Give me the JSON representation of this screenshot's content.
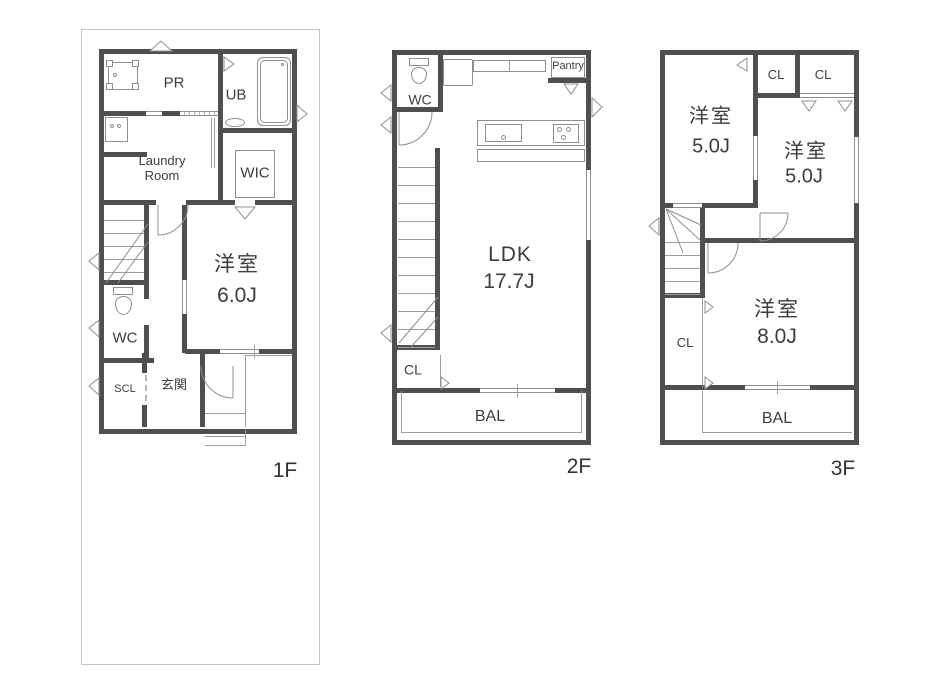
{
  "colors": {
    "wall": "#4f4f4f",
    "thin_line": "#9e9e9e",
    "text": "#3d3d3d",
    "boundary": "#c5c5c5",
    "background": "#ffffff"
  },
  "floors": [
    {
      "label": "1F",
      "rooms": {
        "pr": "PR",
        "ub": "UB",
        "laundry_l1": "Laundry",
        "laundry_l2": "Room",
        "wic": "WIC",
        "bedroom_name": "洋室",
        "bedroom_size": "6.0J",
        "wc": "WC",
        "scl": "SCL",
        "entrance": "玄関"
      }
    },
    {
      "label": "2F",
      "rooms": {
        "wc": "WC",
        "pantry": "Pantry",
        "ldk_name": "LDK",
        "ldk_size": "17.7J",
        "cl": "CL",
        "balcony": "BAL"
      }
    },
    {
      "label": "3F",
      "rooms": {
        "bedroom1_name": "洋室",
        "bedroom1_size": "5.0J",
        "cl1": "CL",
        "cl2": "CL",
        "bedroom2_name": "洋室",
        "bedroom2_size": "5.0J",
        "cl3": "CL",
        "bedroom3_name": "洋室",
        "bedroom3_size": "8.0J",
        "balcony": "BAL"
      }
    }
  ]
}
